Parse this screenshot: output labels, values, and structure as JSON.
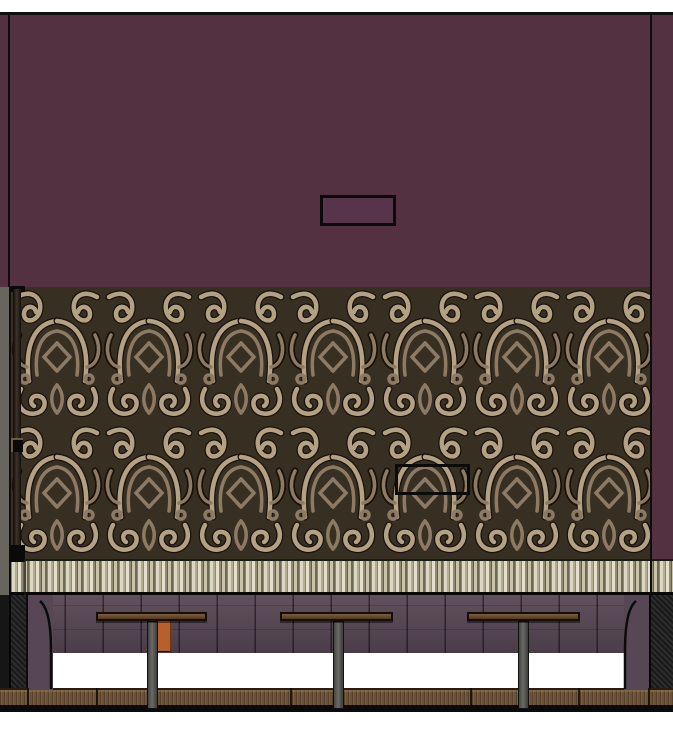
{
  "meta": {
    "title": "Banquette Wall Interior Elevation",
    "drawing_type": "interior elevation rendering",
    "visible_text": "none"
  },
  "colors": {
    "paint_upper_wall": "#533140",
    "upper_box_fill": "#573449",
    "wallpaper_bg": "#382f23",
    "wallpaper_motif_light": "#b3a186",
    "wallpaper_motif_mid": "#8c7a64",
    "tile_base": "#cfcab5",
    "side_gray": "#68655f",
    "banquette_back": "#574754",
    "banquette_seat": "#35393a",
    "end_panel": "#232323",
    "wood_base": "#6b5236",
    "table_wood": "#6f5535",
    "table_leg": "#5d5d5b",
    "accent_orange": "#b8602b",
    "floor": "#0a0a0a",
    "outline": "#0b0b0b",
    "border_black": "#101010"
  },
  "scene": {
    "upper_wall": {
      "finish": "painted plum wall",
      "features": [
        "recessed blocking outline box"
      ]
    },
    "wallpaper_panel": {
      "finish": "brown-tan damask wallpaper",
      "features": [
        "blocking outline box",
        "drapery rod at left"
      ]
    },
    "wainscot": {
      "finish": "vertical striped tile band"
    },
    "banquette": {
      "back_finish": "plum channel-stitched upholstery",
      "seat_finish": "charcoal cushions",
      "base_finish": "wood plinth",
      "cushion_sections": 15,
      "arms": 2,
      "end_panels": 2
    },
    "tables": {
      "count": 3,
      "style": "wood top with metal pedestal leg"
    },
    "accents": {
      "orange_chair_back": 1
    }
  }
}
